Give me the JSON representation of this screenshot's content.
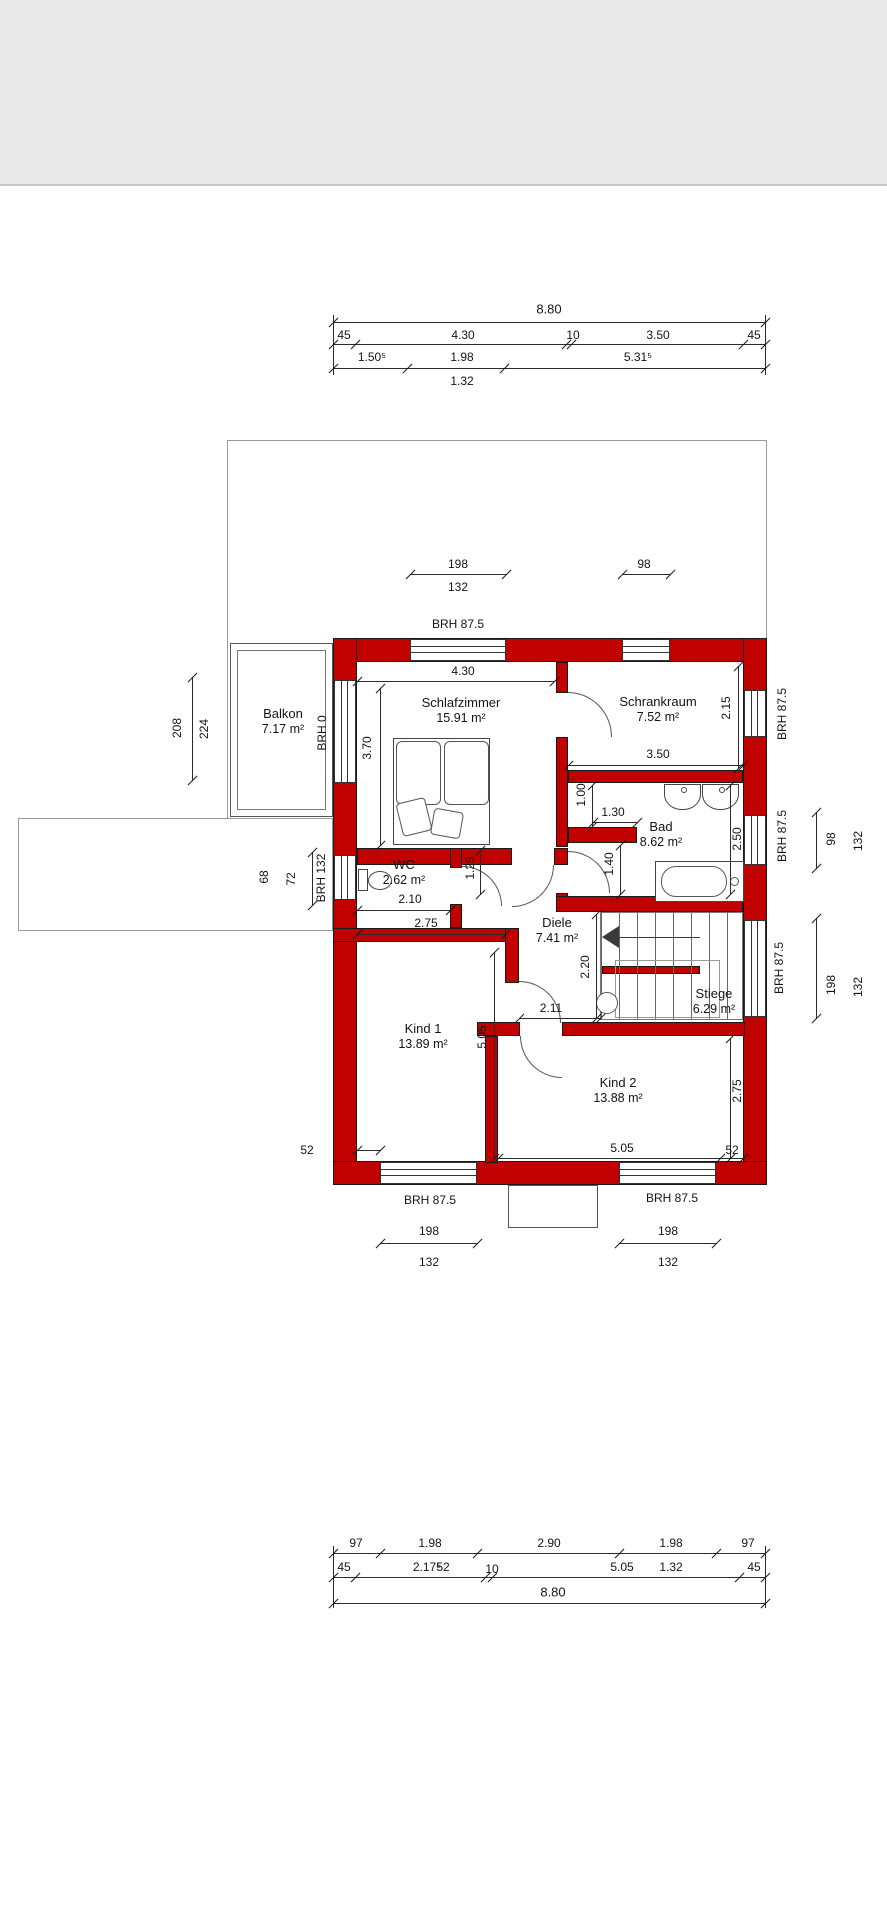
{
  "plan": {
    "rooms": [
      {
        "id": "balkon",
        "name": "Balkon",
        "area": "7.17 m²"
      },
      {
        "id": "schlafzimmer",
        "name": "Schlafzimmer",
        "area": "15.91 m²"
      },
      {
        "id": "schrankraum",
        "name": "Schrankraum",
        "area": "7.52 m²"
      },
      {
        "id": "wc",
        "name": "WC",
        "area": "2.62 m²"
      },
      {
        "id": "bad",
        "name": "Bad",
        "area": "8.62 m²"
      },
      {
        "id": "diele",
        "name": "Diele",
        "area": "7.41 m²"
      },
      {
        "id": "stiege",
        "name": "Stiege",
        "area": "6.29 m²"
      },
      {
        "id": "kind1",
        "name": "Kind 1",
        "area": "13.89 m²"
      },
      {
        "id": "kind2",
        "name": "Kind 2",
        "area": "13.88 m²"
      }
    ],
    "chains": {
      "top": {
        "total": "8.80",
        "row2": [
          "45",
          "4.30",
          "10",
          "3.50",
          "45"
        ],
        "row3": [
          "1.50⁵",
          "1.98",
          "5.31⁵"
        ],
        "row4": "1.32"
      },
      "bottom": {
        "row1": [
          "97",
          "1.98",
          "2.90",
          "1.98",
          "97"
        ],
        "row2": [
          "45",
          "2.17⁵",
          "52",
          "10",
          "5.05",
          "1.32",
          "45"
        ],
        "total": "8.80"
      }
    },
    "windows": {
      "north_left": {
        "width": "198",
        "height": "132",
        "brh": "BRH 87.5"
      },
      "north_right": {
        "width": "98"
      },
      "balkon_depth": {
        "a": "208",
        "b": "224"
      },
      "west_balkon_brh": "BRH 0",
      "wc_win": {
        "a": "68",
        "b": "72"
      },
      "west_wc_brh": "BRH 132",
      "east_schrank_brh": "BRH 87.5",
      "east_bad_brh": "BRH 87.5",
      "east_bad": {
        "width": "98",
        "height": "132"
      },
      "east_stiege_brh": "BRH 87.5",
      "east_stiege": {
        "width": "198",
        "height": "132"
      },
      "south_left": {
        "brh": "BRH 87.5",
        "width": "198",
        "height": "132"
      },
      "south_right": {
        "brh": "BRH 87.5",
        "width": "198",
        "height": "132"
      }
    },
    "dims": {
      "schlaf_width": "4.30",
      "schlaf_depth": "3.70",
      "schrank_depth": "2.15",
      "schrank_width": "3.50",
      "bad_niche": "1.00",
      "bad_door": "1.30",
      "bad_entry": "1.40",
      "bad_depth": "2.50",
      "wc_width": "2.10",
      "wc_niche": "1.25",
      "kind1_width": "2.75",
      "kind1_depth": "5.05",
      "diele_depth": "2.20",
      "diele_width": "2.11",
      "kind2_width": "5.05",
      "kind2_depth": "2.75",
      "pier_left": "52",
      "pier_right": "52"
    }
  }
}
